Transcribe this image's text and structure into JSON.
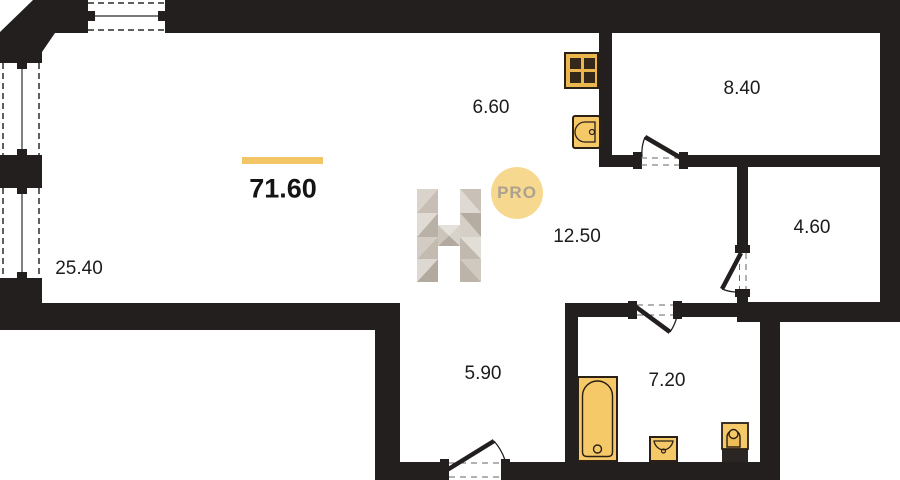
{
  "plan": {
    "total_area": "71.60",
    "watermark": {
      "letter": "H",
      "badge_label": "PRO"
    },
    "rooms": [
      {
        "name": "living-room",
        "area": "25.40"
      },
      {
        "name": "kitchen",
        "area": "6.60"
      },
      {
        "name": "bedroom",
        "area": "8.40"
      },
      {
        "name": "hallway",
        "area": "12.50"
      },
      {
        "name": "storage",
        "area": "4.60"
      },
      {
        "name": "corridor",
        "area": "5.90"
      },
      {
        "name": "bathroom",
        "area": "7.20"
      }
    ],
    "fixtures": [
      {
        "icon": "stove-icon"
      },
      {
        "icon": "kitchen-sink-icon"
      },
      {
        "icon": "bathtub-icon"
      },
      {
        "icon": "washbasin-icon"
      },
      {
        "icon": "toilet-icon"
      }
    ],
    "colors": {
      "wall": "#231f1f",
      "accent_bar": "#f2c666",
      "fixture_fill": "#f5c868",
      "fixture_stroke": "#2a2016",
      "badge_fill": "#f6d98e",
      "badge_text": "#aca191",
      "label_text": "#1c1c1c"
    }
  }
}
